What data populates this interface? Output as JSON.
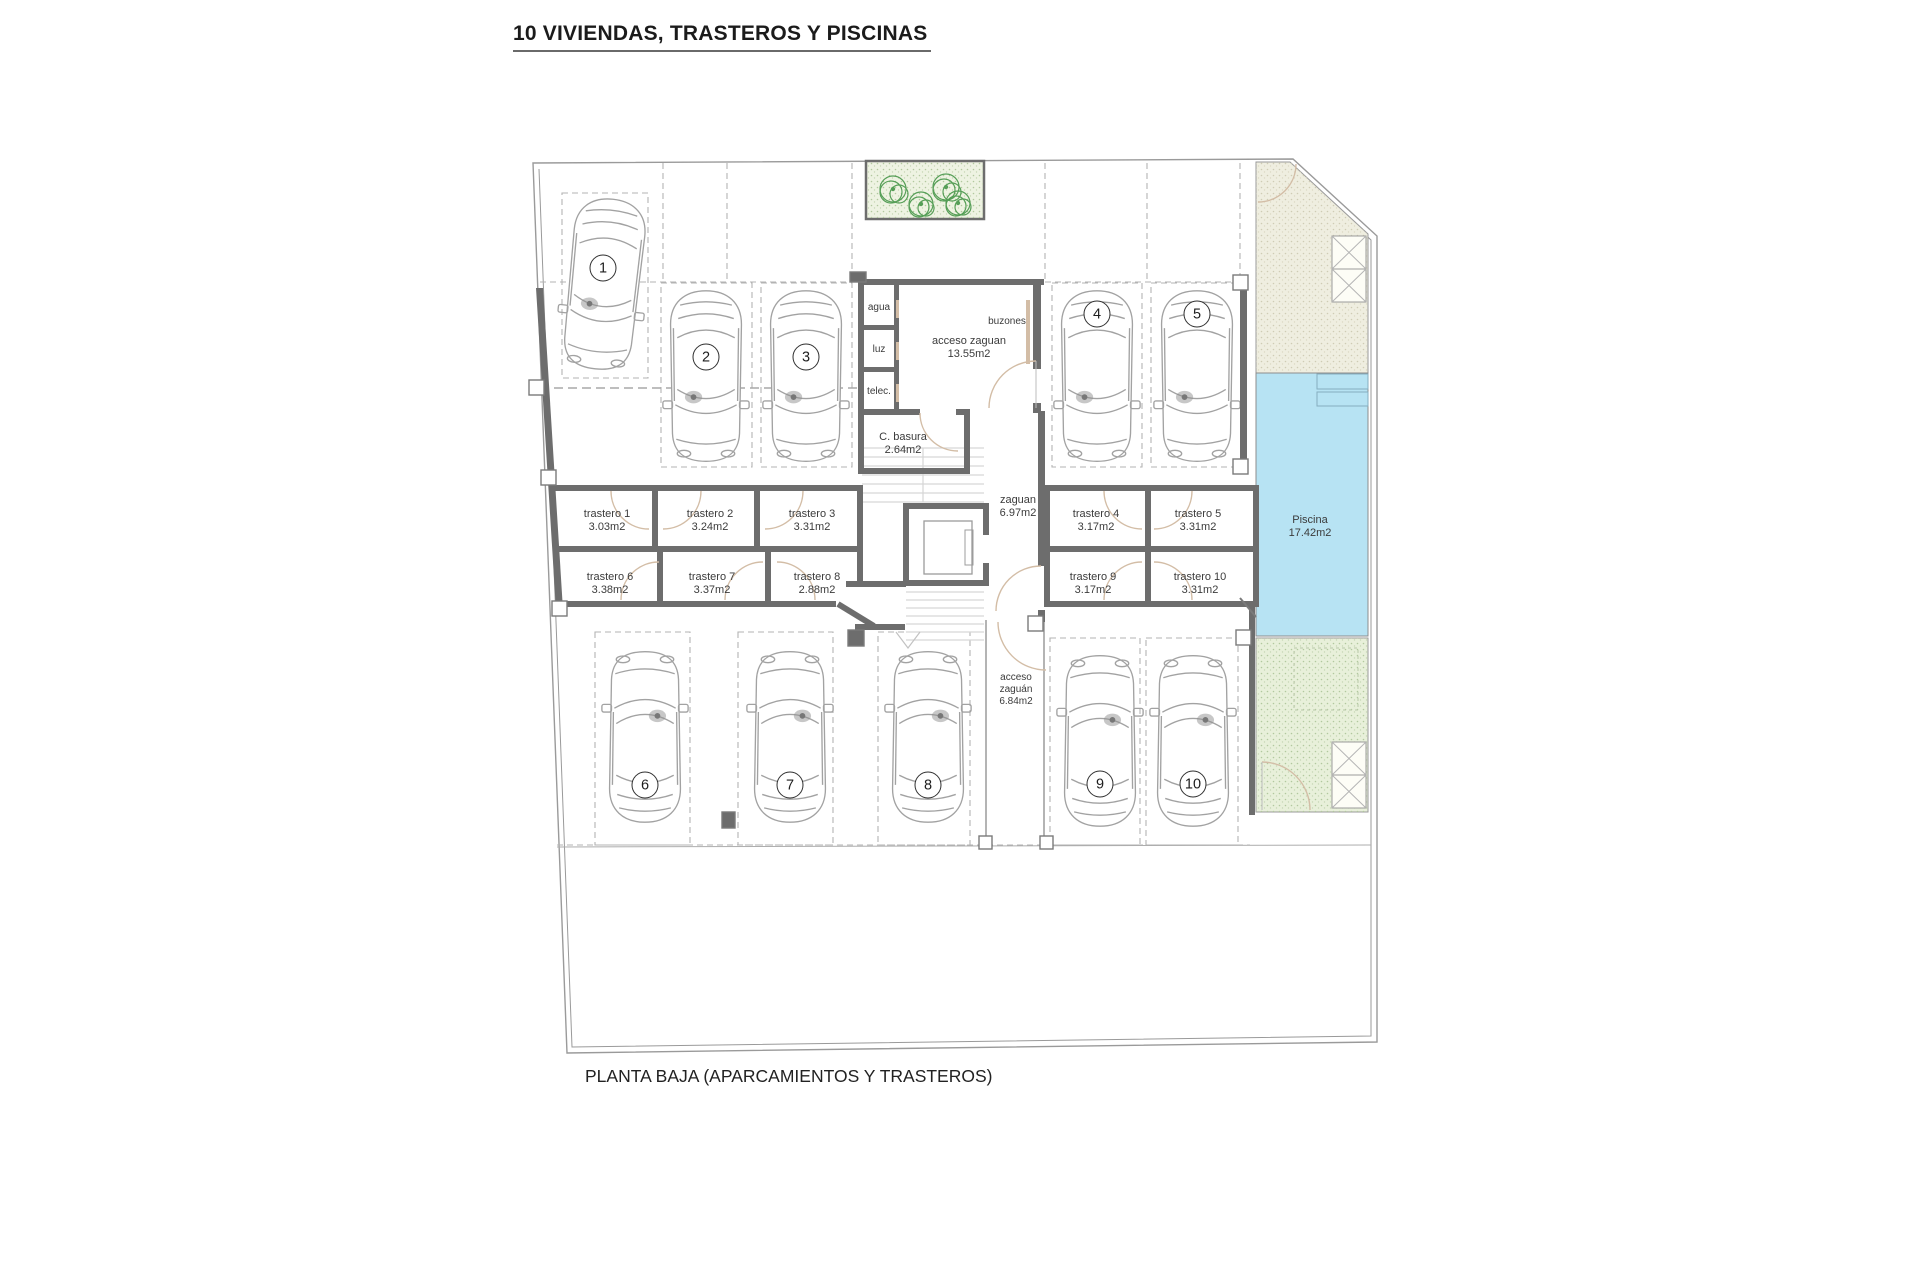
{
  "title": "10 VIVIENDAS, TRASTEROS Y PISCINAS",
  "caption": "PLANTA BAJA (APARCAMIENTOS Y TRASTEROS)",
  "parking_spaces": [
    "1",
    "2",
    "3",
    "4",
    "5",
    "6",
    "7",
    "8",
    "9",
    "10"
  ],
  "trasteros": [
    {
      "name": "trastero 1",
      "area": "3.03m2"
    },
    {
      "name": "trastero 2",
      "area": "3.24m2"
    },
    {
      "name": "trastero 3",
      "area": "3.31m2"
    },
    {
      "name": "trastero 4",
      "area": "3.17m2"
    },
    {
      "name": "trastero 5",
      "area": "3.31m2"
    },
    {
      "name": "trastero 6",
      "area": "3.38m2"
    },
    {
      "name": "trastero 7",
      "area": "3.37m2"
    },
    {
      "name": "trastero 8",
      "area": "2.88m2"
    },
    {
      "name": "trastero 9",
      "area": "3.17m2"
    },
    {
      "name": "trastero 10",
      "area": "3.31m2"
    }
  ],
  "rooms": {
    "acceso_zaguan": {
      "name": "acceso zaguan",
      "area": "13.55m2"
    },
    "buzones": {
      "name": "buzones"
    },
    "agua": {
      "name": "agua"
    },
    "luz": {
      "name": "luz"
    },
    "telec": {
      "name": "telec."
    },
    "c_basura": {
      "name": "C. basura",
      "area": "2.64m2"
    },
    "zaguan": {
      "name": "zaguan",
      "area": "6.97m2"
    },
    "acceso_zaguan_sur": {
      "line1": "acceso",
      "line2": "zaguán",
      "area": "6.84m2"
    },
    "piscina": {
      "name": "Piscina",
      "area": "17.42m2"
    }
  },
  "colors": {
    "wall": "#6d6d6d",
    "pool": "#b7e3f3",
    "lawn": "#e8f0da",
    "garden": "#efeee0",
    "plant": "#3d9140",
    "door": "#d3bda6"
  }
}
